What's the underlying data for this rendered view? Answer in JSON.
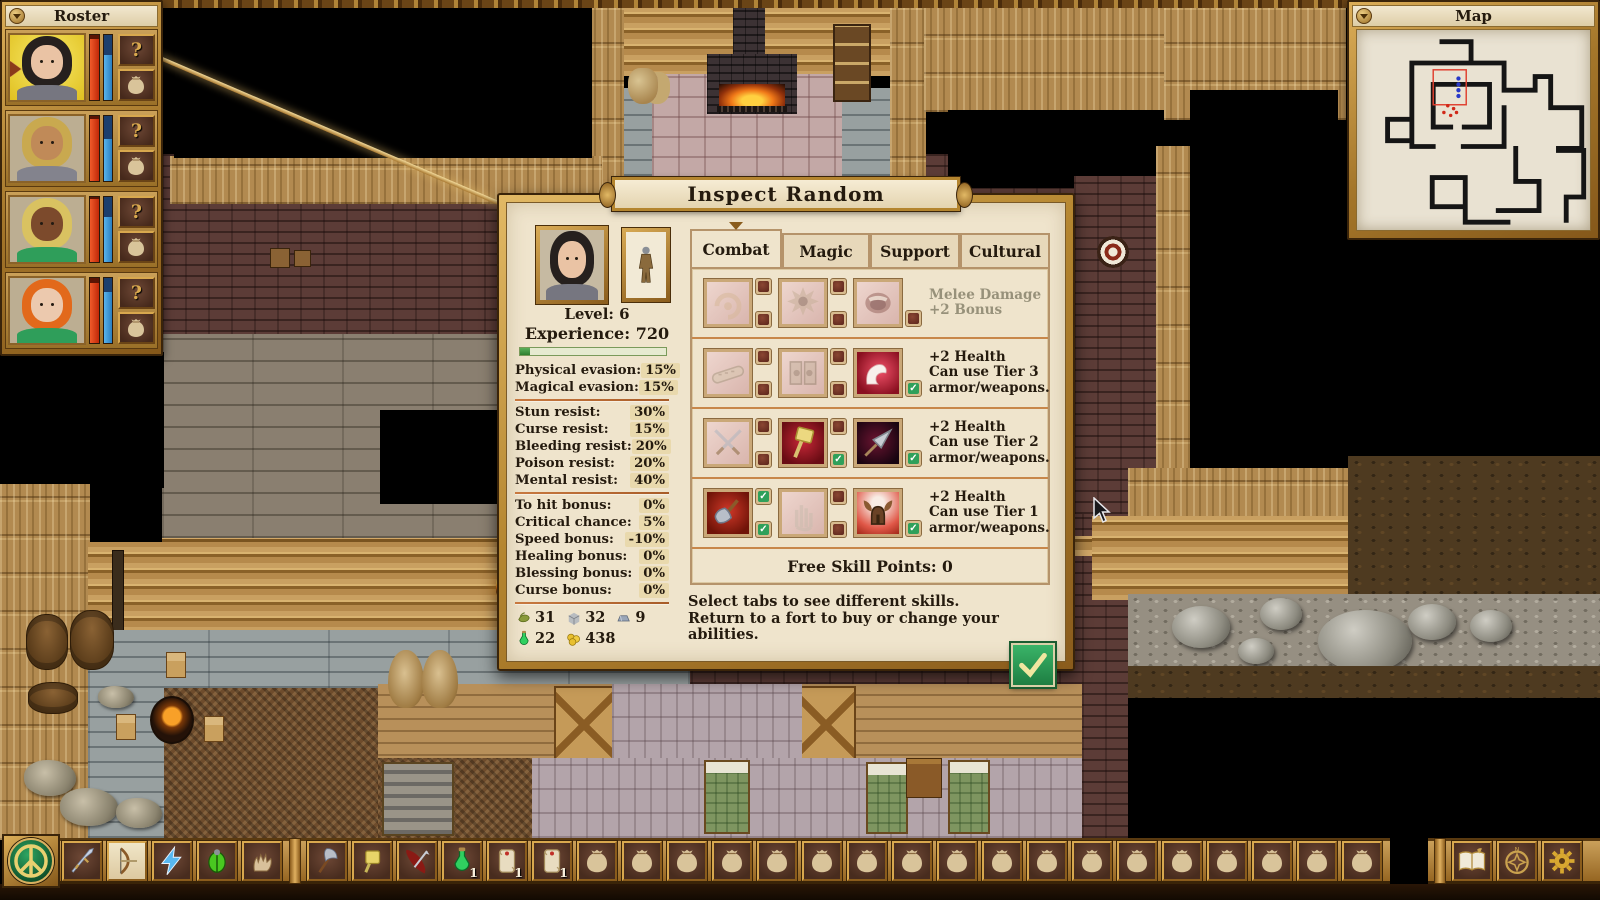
{
  "colors": {
    "gold": "#b98733",
    "gold_light": "#dcae58",
    "gold_dark": "#7e561a",
    "parchment": "#efe4cc",
    "ink": "#241a0e",
    "divider": "#c8874a",
    "value_chip": "#e9d9ad",
    "hp_red": "#e23b10",
    "mp_blue": "#3f9fdc",
    "check_green": "#2fa05a",
    "muted_text": "#97917a"
  },
  "roster": {
    "title": "Roster",
    "query_label": "?",
    "members": [
      {
        "id": "member-1",
        "selected": true,
        "hp": 94,
        "mp": 70,
        "hair": "#26201e",
        "skin": "#eac3a4",
        "shirt": "#767680"
      },
      {
        "id": "member-2",
        "selected": false,
        "hp": 96,
        "mp": 64,
        "hair": "#c9a94f",
        "skin": "#c08a58",
        "shirt": "#83838d"
      },
      {
        "id": "member-3",
        "selected": false,
        "hp": 97,
        "mp": 70,
        "hair": "#d9c261",
        "skin": "#7c4a2c",
        "shirt": "#2f9e5a"
      },
      {
        "id": "member-4",
        "selected": false,
        "hp": 92,
        "mp": 78,
        "hair": "#e2691b",
        "skin": "#ecc9ae",
        "shirt": "#2f9e5a"
      }
    ]
  },
  "map": {
    "title": "Map"
  },
  "dialog": {
    "title": "Inspect Random",
    "level": "Level: 6",
    "experience": "Experience: 720",
    "xp_percent": 7,
    "stat_groups": [
      [
        {
          "label": "Physical evasion:",
          "value": "15%"
        },
        {
          "label": "Magical evasion:",
          "value": "15%"
        }
      ],
      [
        {
          "label": "Stun resist:",
          "value": "30%"
        },
        {
          "label": "Curse resist:",
          "value": "15%"
        },
        {
          "label": "Bleeding resist:",
          "value": "20%"
        },
        {
          "label": "Poison resist:",
          "value": "20%"
        },
        {
          "label": "Mental resist:",
          "value": "40%"
        }
      ],
      [
        {
          "label": "To hit bonus:",
          "value": "0%"
        },
        {
          "label": "Critical chance:",
          "value": "5%"
        },
        {
          "label": "Speed bonus:",
          "value": "-10%"
        },
        {
          "label": "Healing bonus:",
          "value": "0%"
        },
        {
          "label": "Blessing bonus:",
          "value": "0%"
        },
        {
          "label": "Curse bonus:",
          "value": "0%"
        }
      ]
    ],
    "currencies": [
      {
        "icon": "herb",
        "value": "31"
      },
      {
        "icon": "stone",
        "value": "32"
      },
      {
        "icon": "ingot",
        "value": "9"
      },
      {
        "icon": "potion",
        "value": "22"
      },
      {
        "icon": "coins",
        "value": "438"
      }
    ],
    "tabs": [
      {
        "label": "Combat",
        "active": true
      },
      {
        "label": "Magic",
        "active": false
      },
      {
        "label": "Support",
        "active": false
      },
      {
        "label": "Cultural",
        "active": false
      }
    ],
    "skill_rows": [
      {
        "desc": [
          "Melee Damage",
          "+2 Bonus"
        ],
        "muted": true,
        "cells": [
          {
            "icon": "ram-head",
            "active": false,
            "boxes": [
              false,
              false
            ]
          },
          {
            "icon": "spiked-burst",
            "active": false,
            "boxes": [
              false,
              false
            ]
          },
          {
            "icon": "war-shout",
            "active": false,
            "boxes": [
              false
            ]
          }
        ]
      },
      {
        "desc": [
          "+2 Health",
          "Can use Tier 3",
          "armor/weapons."
        ],
        "muted": false,
        "cells": [
          {
            "icon": "bandage",
            "active": false,
            "boxes": [
              false,
              false
            ]
          },
          {
            "icon": "shield-doors",
            "active": false,
            "boxes": [
              false,
              false
            ]
          },
          {
            "icon": "flex-arm",
            "active": true,
            "boxes": [
              true
            ]
          }
        ]
      },
      {
        "desc": [
          "+2 Health",
          "Can use Tier 2",
          "armor/weapons."
        ],
        "muted": false,
        "cells": [
          {
            "icon": "crossed-daggers",
            "active": false,
            "boxes": [
              false,
              false
            ]
          },
          {
            "icon": "war-hammer",
            "active": true,
            "boxes": [
              false,
              true
            ]
          },
          {
            "icon": "spearhead",
            "active": true,
            "boxes": [
              true
            ]
          }
        ]
      },
      {
        "desc": [
          "+2 Health",
          "Can use Tier 1",
          "armor/weapons."
        ],
        "muted": false,
        "cells": [
          {
            "icon": "war-axe",
            "active": true,
            "boxes": [
              true,
              true
            ]
          },
          {
            "icon": "open-hand",
            "active": false,
            "boxes": [
              false,
              false
            ]
          },
          {
            "icon": "horned-helm",
            "active": true,
            "boxes": [
              true
            ]
          }
        ]
      }
    ],
    "free_points": "Free Skill Points: 0",
    "hints": [
      "Select tabs to see different skills.",
      "Return to a fort to buy or change your abilities."
    ]
  },
  "toolbar": {
    "ability_slots": [
      {
        "icon": "sword",
        "selected": false
      },
      {
        "icon": "bow",
        "selected": true
      },
      {
        "icon": "lightning",
        "selected": false
      },
      {
        "icon": "beetle",
        "selected": false
      },
      {
        "icon": "gauntlet",
        "selected": false
      }
    ],
    "item_slots": [
      {
        "icon": "axe-item",
        "count": ""
      },
      {
        "icon": "hammer-item",
        "count": ""
      },
      {
        "icon": "cloak-dagger",
        "count": ""
      },
      {
        "icon": "potion",
        "count": "1"
      },
      {
        "icon": "scroll",
        "count": "1"
      },
      {
        "icon": "scroll",
        "count": "1"
      }
    ],
    "empty_slot_count": 18,
    "system_buttons": [
      {
        "icon": "journal"
      },
      {
        "icon": "compass"
      },
      {
        "icon": "settings"
      }
    ]
  }
}
